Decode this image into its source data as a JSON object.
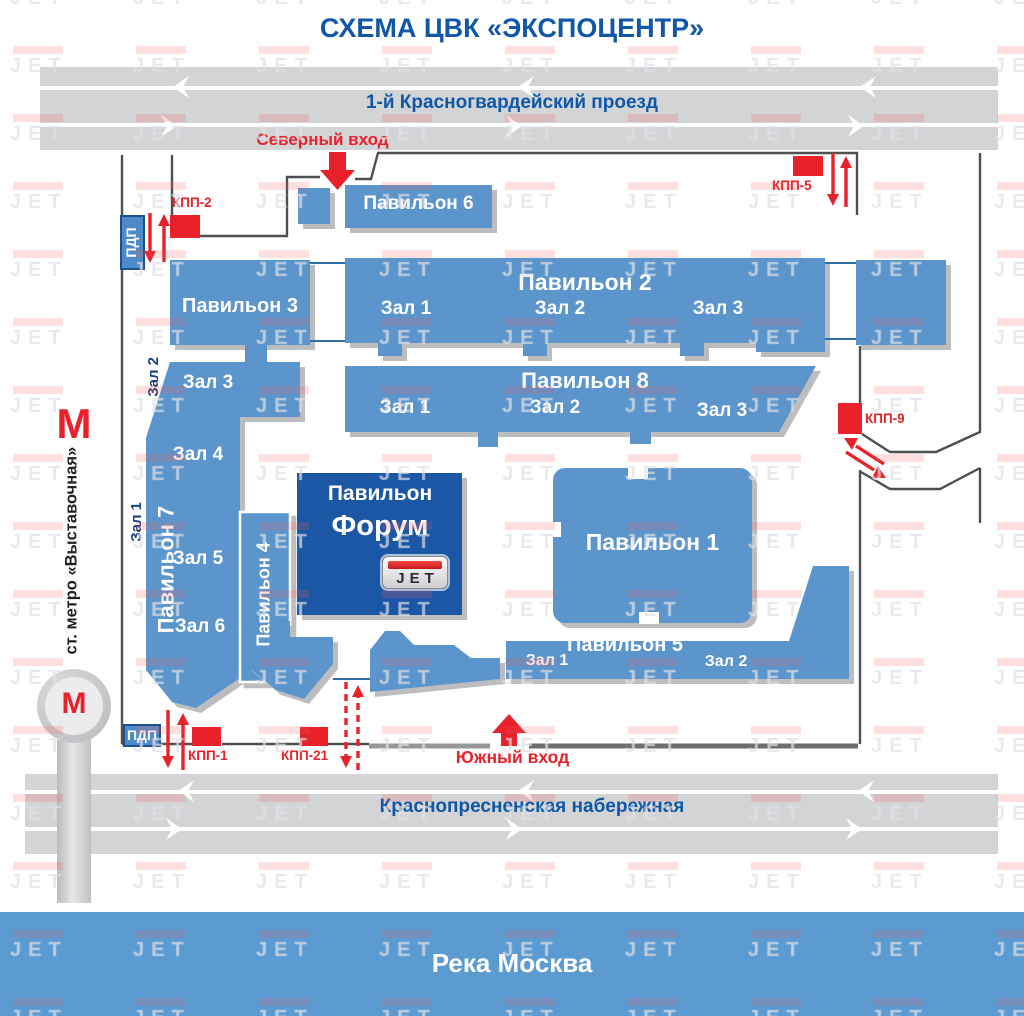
{
  "title": "СХЕМА ЦВК «ЭКСПОЦЕНТР»",
  "watermark": "JET",
  "colors": {
    "pavilion": "#5b95cc",
    "forum": "#1c57a6",
    "red": "#e8212a",
    "road": "#d3d4d6",
    "river": "#5b9bd2",
    "blue_text": "#1057a8",
    "fence": "#4f4f4f",
    "pdp_fill": "#4d8ac8",
    "shadow": "#bdbdbf"
  },
  "roads": {
    "top": "1-й Красногвардейский проезд",
    "bottom": "Краснопресненская набережная"
  },
  "river": "Река Москва",
  "entrances": {
    "north": "Северный вход",
    "south": "Южный вход"
  },
  "checkpoints": {
    "kpp1": "КПП-1",
    "kpp2": "КПП-2",
    "kpp5": "КПП-5",
    "kpp9": "КПП-9",
    "kpp21": "КПП-21"
  },
  "pdp": {
    "top": "ПДП",
    "bottom": "ПДП"
  },
  "metro": {
    "m": "М",
    "station": "ст. метро «Выставочная»"
  },
  "pavilions": {
    "p1": {
      "label": "Павильон 1"
    },
    "p2": {
      "label": "Павильон 2",
      "halls": [
        "Зал 1",
        "Зал 2",
        "Зал 3"
      ]
    },
    "p3": {
      "label": "Павильон 3"
    },
    "p4": {
      "label": "Павильон 4"
    },
    "p5": {
      "label": "Павильон 5",
      "halls": [
        "Зал 1",
        "Зал 2"
      ]
    },
    "p6": {
      "label": "Павильон 6"
    },
    "p7": {
      "label": "Павильон 7",
      "halls": [
        "Зал 3",
        "Зал 4",
        "Зал 5",
        "Зал 6"
      ],
      "outside_halls": [
        "Зал 1",
        "Зал 2"
      ]
    },
    "p8": {
      "label": "Павильон 8",
      "halls": [
        "Зал 1",
        "Зал 2",
        "Зал 3"
      ]
    },
    "forum": {
      "label_top": "Павильон",
      "label": "Форум",
      "logo": "JET"
    }
  }
}
